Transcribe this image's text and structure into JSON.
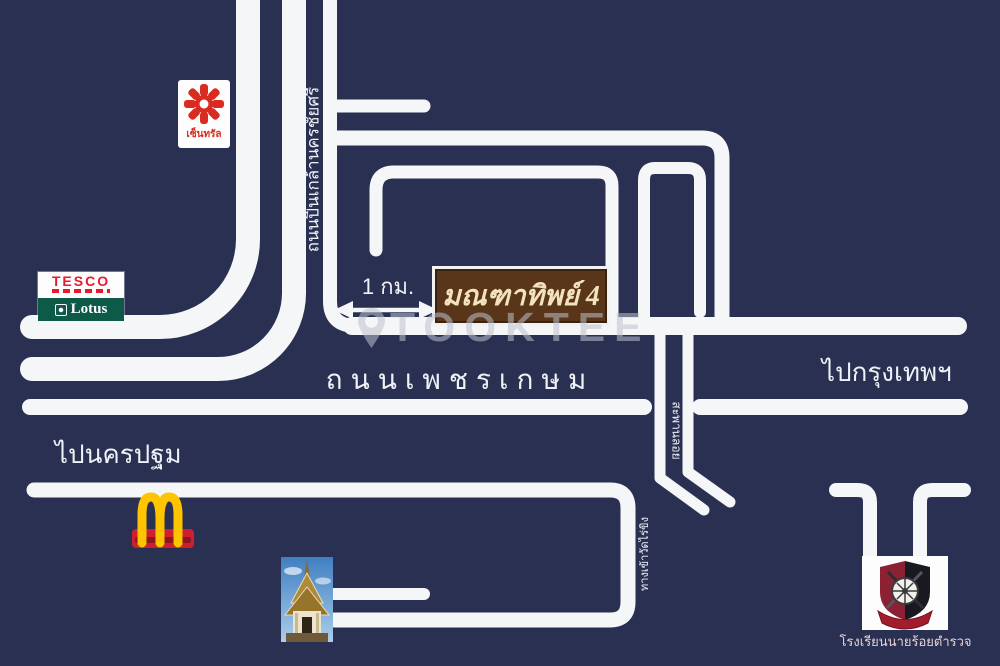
{
  "map": {
    "colors": {
      "background": "#2a3052",
      "road": "#f5f6f8",
      "watermark": "rgba(188,193,204,0.55)",
      "sign_background": "#59351a",
      "sign_text": "#f3e3bb",
      "central_red": "#d92b1f",
      "tesco_red": "#e8192c",
      "lotus_green": "#0d5a49",
      "mcdonalds_yellow": "#ffc400",
      "mcdonalds_red": "#cf1f2e",
      "crest_maroon": "#8c2133",
      "crest_black": "#191922"
    },
    "watermark": {
      "text": "TOOKTEE",
      "icon": "location-pin-icon"
    },
    "destination_sign": {
      "label": "มณฑาทิพย์ 4"
    },
    "distance": {
      "label": "1 กม."
    },
    "road_labels": {
      "pinklao": "ถนนปิ่นเกล้านครชัยศรี",
      "phetkasem": "ถนนเพชรเกษม",
      "to_bangkok": "ไปกรุงเทพฯ",
      "to_nakhon_pathom": "ไปนครปฐม",
      "overpass": "สะพานลอย",
      "temple_entrance": "ทางเข้าวัดไร่ขิง"
    },
    "landmarks": {
      "central": {
        "label": "เซ็นทรัล"
      },
      "tesco_lotus": {
        "line1": "TESCO",
        "line2": "Lotus"
      },
      "mcdonalds": {
        "icon": "golden-arches-icon"
      },
      "temple": {
        "icon": "temple-photo"
      },
      "police_academy": {
        "label": "โรงเรียนนายร้อยตำรวจ",
        "icon": "police-crest-icon"
      }
    }
  }
}
